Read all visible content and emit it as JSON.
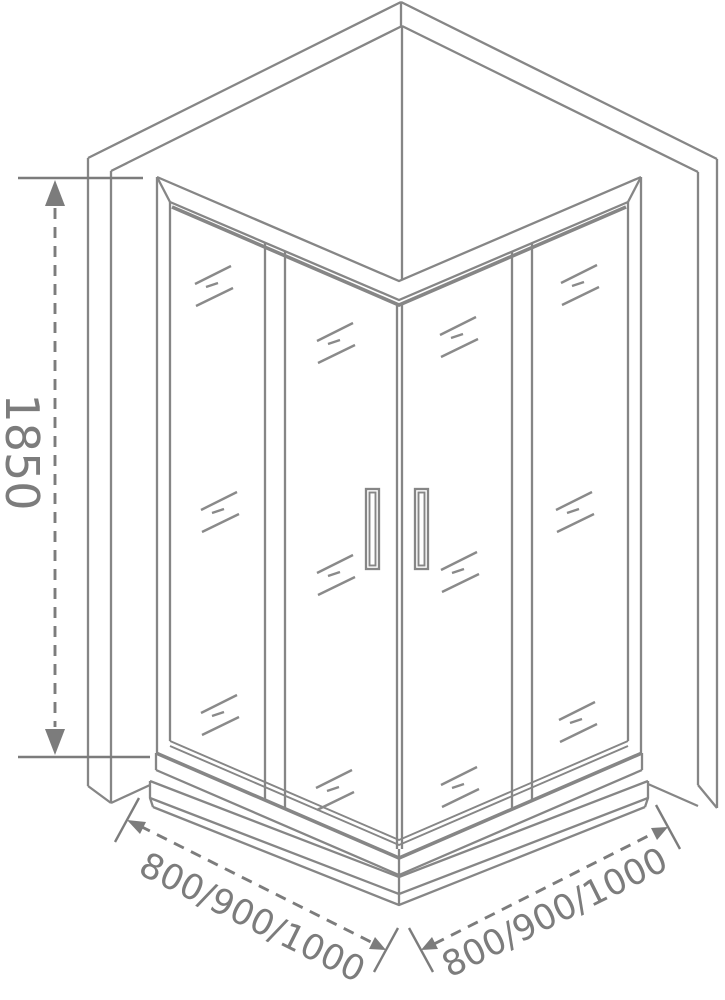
{
  "dimensions": {
    "height": "1850",
    "width_left": "800/900/1000",
    "width_right": "800/900/1000"
  },
  "colors": {
    "line_gray": "#868686",
    "dimension_gray": "#7c7c7c",
    "background": "#ffffff"
  }
}
